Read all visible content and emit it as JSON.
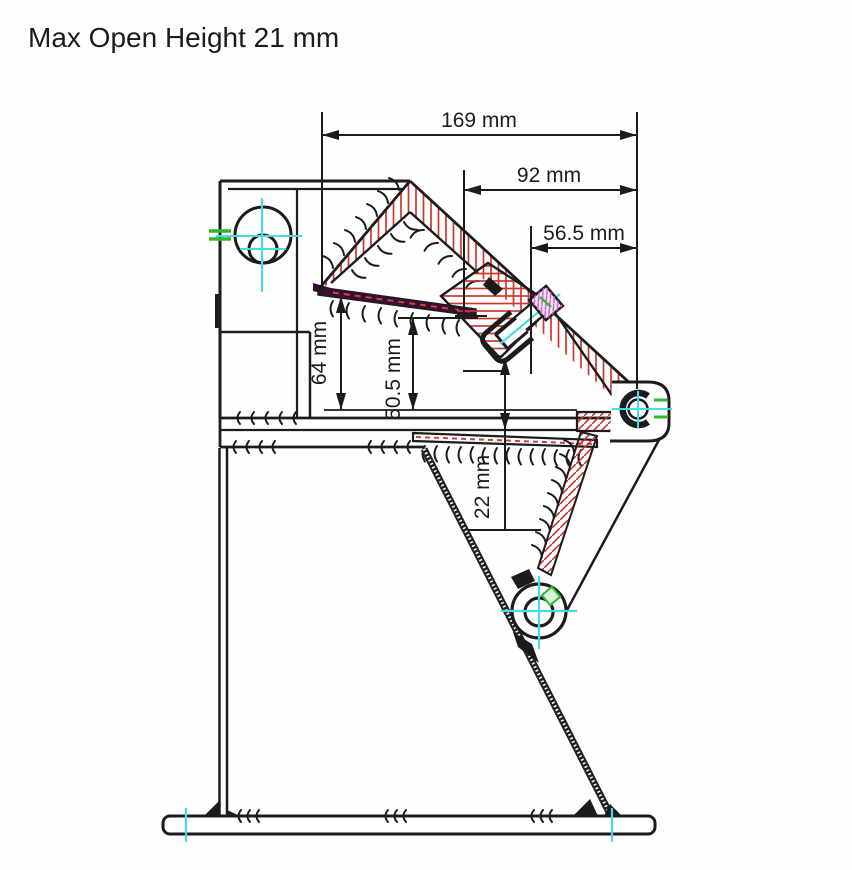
{
  "title": "Max Open Height 21 mm",
  "dimensions": {
    "width_overall": "169 mm",
    "width_mid": "92 mm",
    "width_screw": "56.5 mm",
    "height_jaw": "64 mm",
    "height_mid": "50.5 mm",
    "height_gap": "22 mm"
  },
  "colors": {
    "outline": "#1c1c1c",
    "hatch_red": "#c8382e",
    "centerline_cyan": "#45dce4",
    "datum_green": "#2fba2f",
    "fastener_magenta": "#cf5fcf",
    "background": "#fefefe"
  }
}
